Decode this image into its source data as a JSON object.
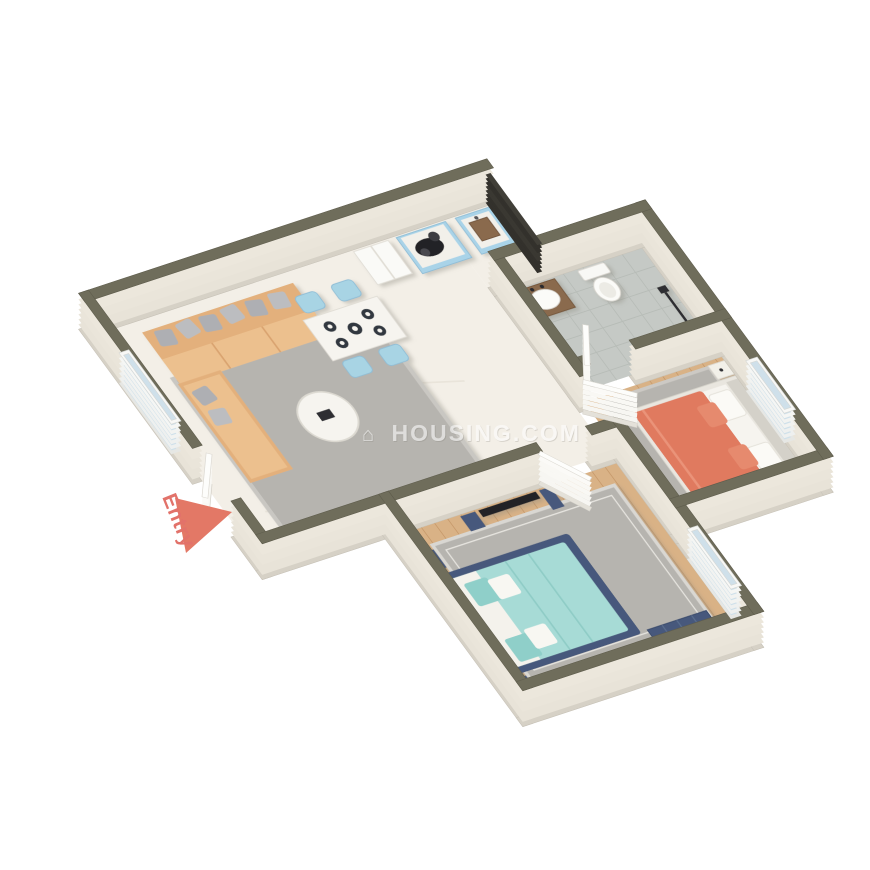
{
  "page": {
    "width": 870,
    "height": 870,
    "background": "#ffffff"
  },
  "scene": {
    "type": "3d-isometric-floor-plan-render",
    "watermark": {
      "logo_glyph": "⌂",
      "text": "HOUSING.COM"
    },
    "entry": {
      "label": "Entry",
      "arrow_color": "#e37866",
      "label_color": "#e2726a"
    }
  },
  "colors": {
    "wall_cap": "#6f6d5b",
    "wall_face": "#e8e3d8",
    "wall_face_dark": "#d6d1c6",
    "floor_marble": "#f3efe7",
    "floor_wood": "#d9b286",
    "floor_tile": "#c5c9c5",
    "rug_grey": "#b6b4af",
    "sofa_tan": "#e3b07c",
    "sofa_seat": "#ecc08e",
    "pillow_grey": "#aeafb3",
    "chair_blue": "#a8d4e4",
    "cabinet_blue": "#a9d3e8",
    "bed1_orange": "#e07a5f",
    "bed2_teal": "#a7dbd6",
    "navy_furniture": "#46597b",
    "wood_dark": "#7a5c42",
    "railing_black": "#33312c",
    "door_white": "#f7f6f2"
  },
  "rooms": [
    {
      "id": "living-dining",
      "floor": "marble",
      "items": [
        "l-shaped-tan-sofa",
        "grey-throw-pillows",
        "grey-area-rug",
        "round-marble-coffee-table",
        "marble-dining-table",
        "four-blue-dining-chairs",
        "table-settings"
      ]
    },
    {
      "id": "kitchen",
      "floor": "marble",
      "items": [
        "refrigerator",
        "blue-island-with-cooktop",
        "blue-island-with-sink"
      ]
    },
    {
      "id": "bathroom",
      "floor": "grey-tile",
      "items": [
        "wood-vanity-with-basin",
        "toilet",
        "shower-set"
      ]
    },
    {
      "id": "bedroom-1",
      "floor": "wood-plank",
      "items": [
        "double-bed-orange-bedding",
        "white-pillows",
        "white-nightstands",
        "grey-rug",
        "tv-with-wood-console"
      ]
    },
    {
      "id": "bedroom-2",
      "floor": "wood-plank",
      "items": [
        "navy-bed-teal-bedding",
        "navy-nightstands-with-lamps",
        "grey-bordered-rug",
        "navy-dresser",
        "wall-tv-with-navy-media-units",
        "window"
      ]
    },
    {
      "id": "balcony-edge",
      "floor": "none",
      "items": [
        "black-railing"
      ]
    }
  ]
}
